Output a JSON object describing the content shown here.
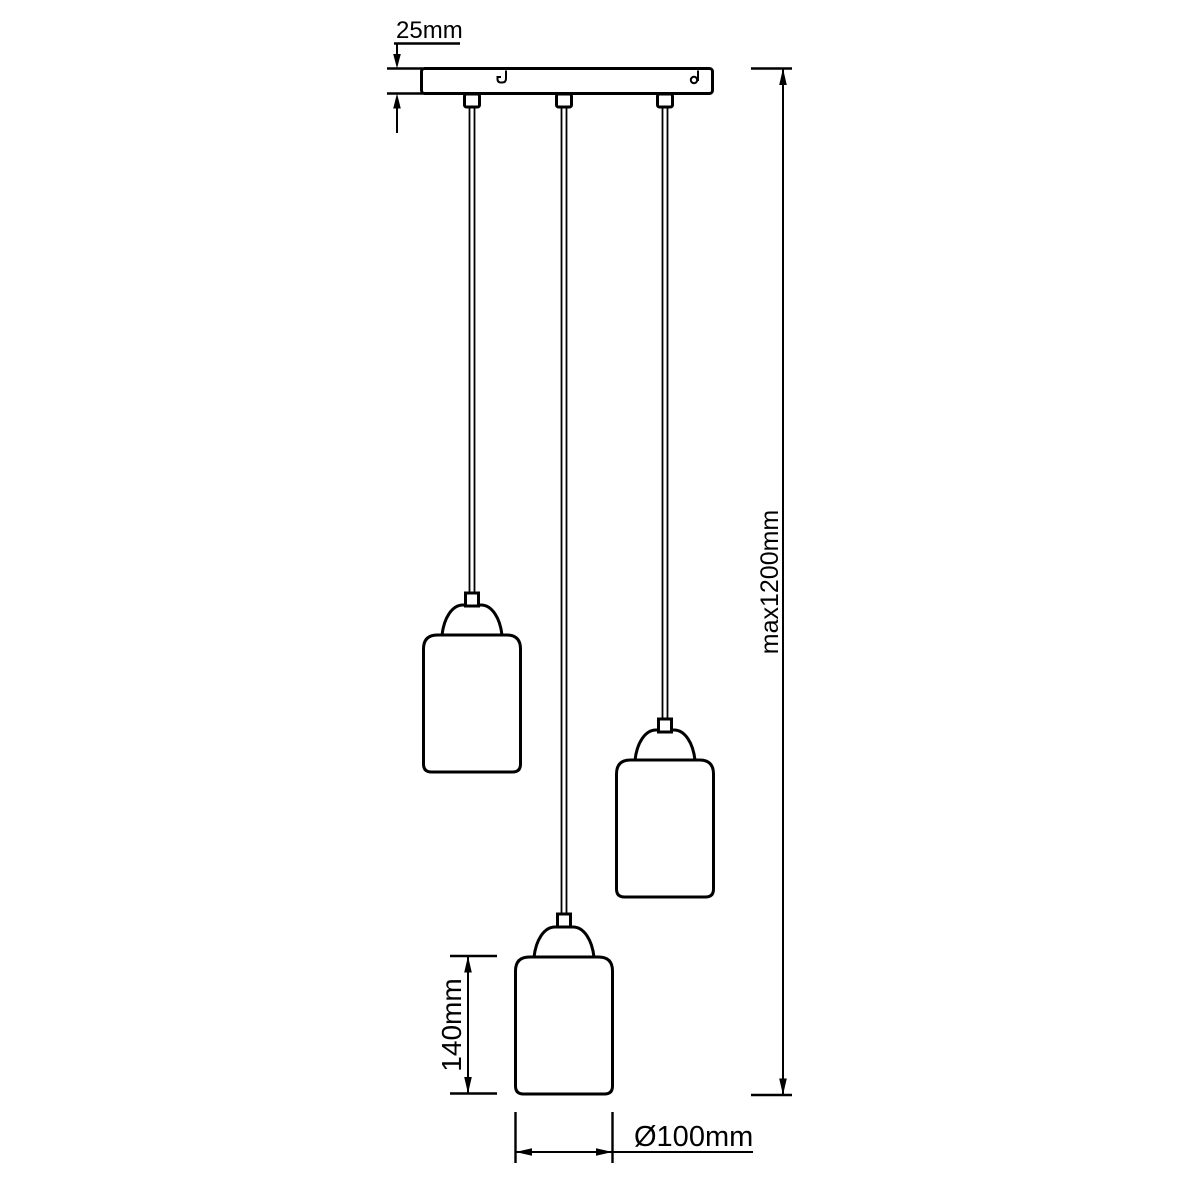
{
  "page": {
    "background": "#ffffff",
    "line_color": "#000000"
  },
  "fixture": {
    "type": "three-light pendant lamp dimension drawing",
    "pendant_count": 3
  },
  "labels": {
    "canopy_depth": "25mm",
    "max_height": "max1200mm",
    "shade_height": "140mm",
    "shade_diameter": "Ø100mm"
  }
}
